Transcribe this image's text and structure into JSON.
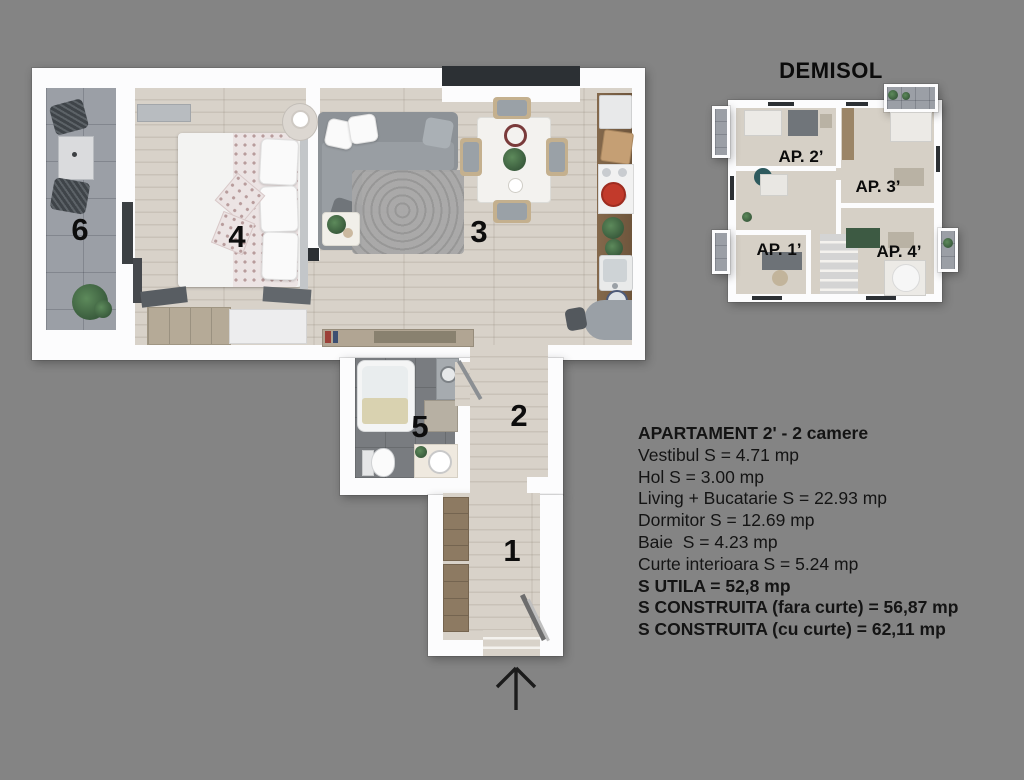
{
  "colors": {
    "bg": "#848484",
    "wall": "#fcfcfd",
    "wood": "#d8d2c9",
    "tile": "#9b9fa6",
    "bath": "#797c80",
    "windowDark": "#2c3034",
    "text": "#141414",
    "sofa": "#8d9297",
    "kwood": "#7c6247",
    "red": "#c23a2b",
    "green": "#49704b",
    "furnWood": "#b5aa97",
    "darkFurn": "#565b60",
    "insetFloor": "#d6d0c6"
  },
  "plan": {
    "room_numbers": {
      "r1": "1",
      "r2": "2",
      "r3": "3",
      "r4": "4",
      "r5": "5",
      "r6": "6"
    }
  },
  "demisol": {
    "title": "DEMISOL",
    "apartments": {
      "ap1": "AP. 1’",
      "ap2": "AP. 2’",
      "ap3": "AP. 3’",
      "ap4": "AP. 4’"
    }
  },
  "info": {
    "title": "APARTAMENT 2' - 2 camere",
    "lines": [
      "Vestibul S = 4.71 mp",
      "Hol S = 3.00 mp",
      "Living + Bucatarie S = 22.93 mp",
      "Dormitor S = 12.69 mp",
      "Baie  S = 4.23 mp",
      "Curte interioara S = 5.24 mp",
      "S UTILA = 52,8 mp",
      "S CONSTRUITA (fara curte) = 56,87 mp",
      "S CONSTRUITA (cu curte) = 62,11 mp"
    ]
  }
}
